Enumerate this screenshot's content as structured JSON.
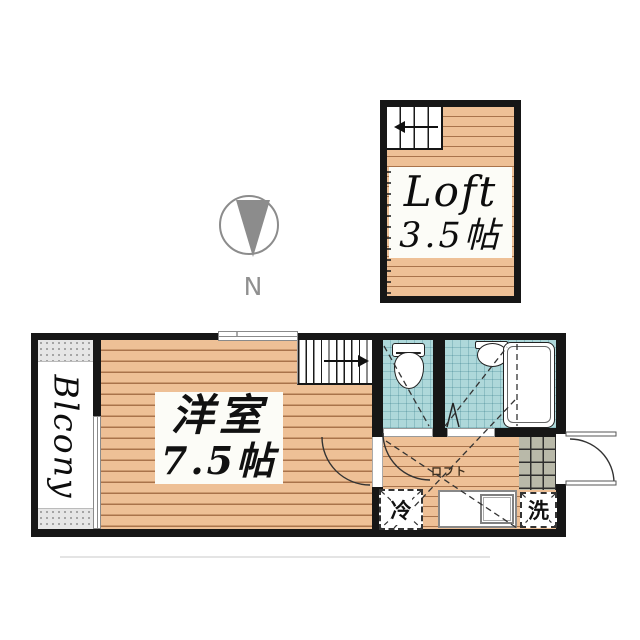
{
  "loft": {
    "name": "Loft",
    "size": "3.5帖"
  },
  "compass": {
    "north_label": "N"
  },
  "room": {
    "name": "洋室",
    "size": "7.5帖"
  },
  "balcony": {
    "label": "Blcony"
  },
  "hallway": {
    "loft_marker": "ロフト"
  },
  "appliances": {
    "fridge": "冷",
    "washer": "洗"
  },
  "colors": {
    "wall": "#161616",
    "wood_floor": "#eec096",
    "wood_plank_line": "#a9734b",
    "wet_area_blue": "#aed8da",
    "entrance_tile": "#b9b9a9",
    "compass_gray": "#8c8c8c"
  }
}
